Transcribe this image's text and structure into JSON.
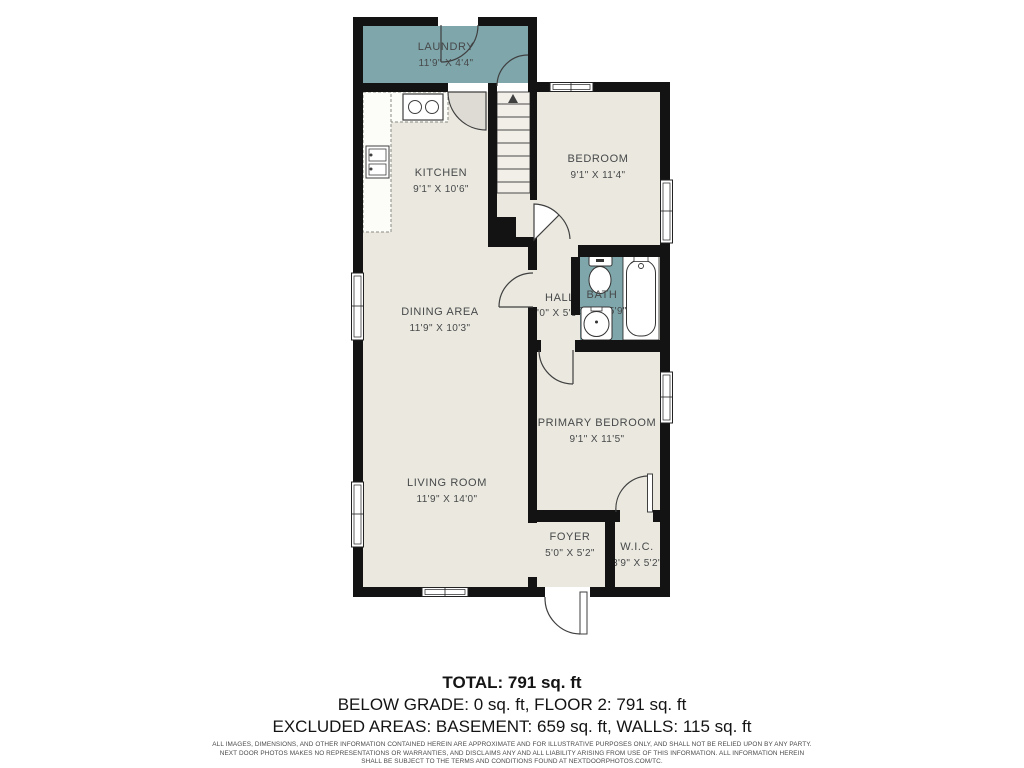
{
  "rooms": {
    "laundry": {
      "name": "LAUNDRY",
      "dims": "11'9\" X 4'4\""
    },
    "kitchen": {
      "name": "KITCHEN",
      "dims": "9'1\" X 10'6\""
    },
    "bedroom": {
      "name": "BEDROOM",
      "dims": "9'1\" X 11'4\""
    },
    "hall": {
      "name": "HALL",
      "dims": "3'0\" X 5'9\""
    },
    "bath": {
      "name": "BATH",
      "dims": "5'1\" X 5'9\""
    },
    "dining": {
      "name": "DINING AREA",
      "dims": "11'9\" X 10'3\""
    },
    "primary": {
      "name": "PRIMARY BEDROOM",
      "dims": "9'1\" X 11'5\""
    },
    "living": {
      "name": "LIVING ROOM",
      "dims": "11'9\" X 14'0\""
    },
    "foyer": {
      "name": "FOYER",
      "dims": "5'0\" X 5'2\""
    },
    "wic": {
      "name": "W.I.C.",
      "dims": "3'9\" X 5'2\""
    }
  },
  "summary": {
    "total": "TOTAL: 791 sq. ft",
    "line2": "BELOW GRADE: 0 sq. ft, FLOOR 2: 791 sq. ft",
    "line3": "EXCLUDED AREAS: BASEMENT: 659 sq. ft, WALLS: 115 sq. ft"
  },
  "disclaimer": {
    "line1": "ALL IMAGES, DIMENSIONS, AND OTHER INFORMATION CONTAINED HEREIN ARE APPROXIMATE AND FOR ILLUSTRATIVE PURPOSES ONLY, AND SHALL NOT BE RELIED UPON BY ANY PARTY.",
    "line2": "NEXT DOOR PHOTOS MAKES NO REPRESENTATIONS OR WARRANTIES, AND DISCLAIMS ANY AND ALL LIABILITY ARISING FROM USE OF THIS INFORMATION. ALL INFORMATION HEREIN",
    "line3": "SHALL BE SUBJECT TO THE TERMS AND CONDITIONS FOUND AT NEXTDOORPHOTOS.COM/TC."
  },
  "colors": {
    "wall": "#131313",
    "floor": "#eae8df",
    "accent_teal": "#7fa6ab",
    "fixture_line": "#3f3f3f",
    "label_text": "#47494a"
  }
}
